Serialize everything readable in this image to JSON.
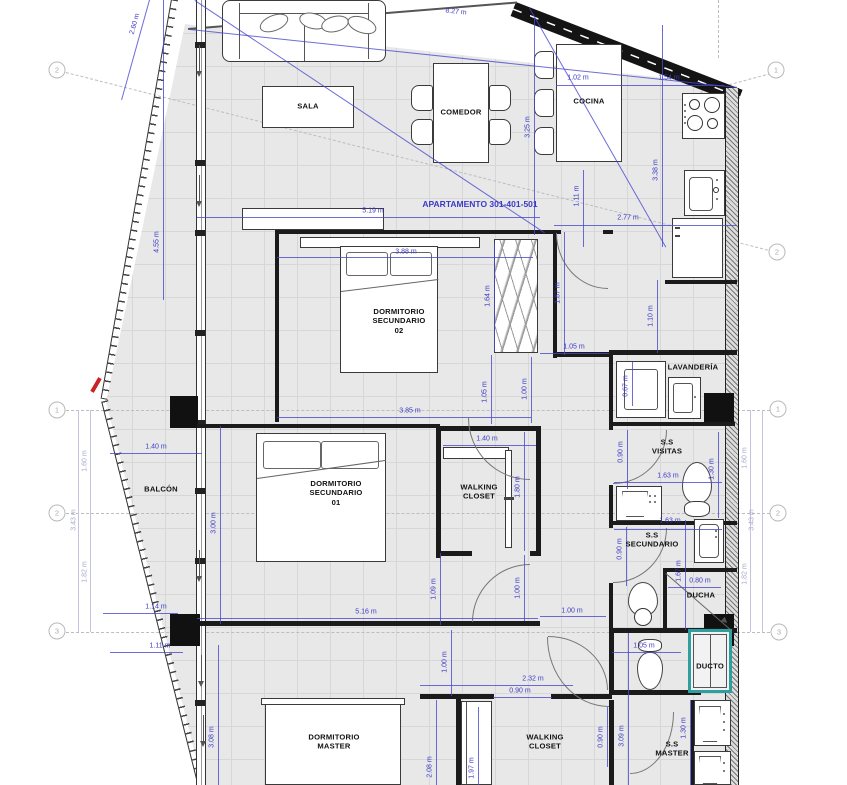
{
  "title": "APARTAMENTO 301-401-501",
  "colors": {
    "dimension_blue": "#3a3ac8",
    "dimension_faded": "#a9a9ce",
    "duct_teal": "#2e9e9e",
    "wall": "#1b1b1b",
    "floor": "#e8e8e8",
    "section_mark_red": "#cc2222"
  },
  "rooms": [
    {
      "name": "SALA",
      "x": 308,
      "y": 106
    },
    {
      "name": "COMEDOR",
      "x": 461,
      "y": 112
    },
    {
      "name": "COCINA",
      "x": 589,
      "y": 101
    },
    {
      "name": "DORMITORIO\nSECUNDARIO\n02",
      "x": 399,
      "y": 321
    },
    {
      "name": "LAVANDERÍA",
      "x": 693,
      "y": 367
    },
    {
      "name": "BALCÓN",
      "x": 161,
      "y": 489
    },
    {
      "name": "DORMITORIO\nSECUNDARIO\n01",
      "x": 336,
      "y": 493
    },
    {
      "name": "WALKING\nCLOSET",
      "x": 479,
      "y": 492
    },
    {
      "name": "S.S\nVISITAS",
      "x": 667,
      "y": 447
    },
    {
      "name": "S.S\nSECUNDARIO",
      "x": 652,
      "y": 540
    },
    {
      "name": "DUCHA",
      "x": 701,
      "y": 595
    },
    {
      "name": "DUCTO",
      "x": 710,
      "y": 666
    },
    {
      "name": "DORMITORIO\nMASTER",
      "x": 334,
      "y": 742
    },
    {
      "name": "WALKING\nCLOSET",
      "x": 545,
      "y": 742
    },
    {
      "name": "S.S\nMASTER",
      "x": 672,
      "y": 749
    }
  ],
  "dimensions": [
    {
      "text": "8.27 m",
      "x": 456,
      "y": 12,
      "rot": 6
    },
    {
      "text": "2.60 m",
      "x": 135,
      "y": 24,
      "rot": -74
    },
    {
      "text": "1.02 m",
      "x": 578,
      "y": 78,
      "rot": 0
    },
    {
      "text": "1.54 m",
      "x": 669,
      "y": 78,
      "rot": 0
    },
    {
      "text": "4.55 m",
      "x": 157,
      "y": 242,
      "rot": -90
    },
    {
      "text": "3.25 m",
      "x": 528,
      "y": 127,
      "rot": -90
    },
    {
      "text": "3.38 m",
      "x": 656,
      "y": 170,
      "rot": -90
    },
    {
      "text": "5.19 m",
      "x": 373,
      "y": 211,
      "rot": 0
    },
    {
      "text": "1.11 m",
      "x": 577,
      "y": 196,
      "rot": -90
    },
    {
      "text": "2.77 m",
      "x": 628,
      "y": 218,
      "rot": 0
    },
    {
      "text": "3.88 m",
      "x": 406,
      "y": 252,
      "rot": 0
    },
    {
      "text": "1.64 m",
      "x": 488,
      "y": 296,
      "rot": -90
    },
    {
      "text": "1.87 m",
      "x": 558,
      "y": 293,
      "rot": -90
    },
    {
      "text": "1.10 m",
      "x": 651,
      "y": 316,
      "rot": -90
    },
    {
      "text": "1.05 m",
      "x": 574,
      "y": 347,
      "rot": 0
    },
    {
      "text": "0.67 m",
      "x": 626,
      "y": 386,
      "rot": -90
    },
    {
      "text": "1.05 m",
      "x": 485,
      "y": 392,
      "rot": -90
    },
    {
      "text": "1.00 m",
      "x": 525,
      "y": 389,
      "rot": -90
    },
    {
      "text": "3.85 m",
      "x": 410,
      "y": 411,
      "rot": 0
    },
    {
      "text": "1.40 m",
      "x": 156,
      "y": 447,
      "rot": 0
    },
    {
      "text": "1.40 m",
      "x": 487,
      "y": 439,
      "rot": 0
    },
    {
      "text": "0.90 m",
      "x": 621,
      "y": 452,
      "rot": -90
    },
    {
      "text": "1.30 m",
      "x": 712,
      "y": 469,
      "rot": -90
    },
    {
      "text": "1.63 m",
      "x": 668,
      "y": 476,
      "rot": 0
    },
    {
      "text": "3.00 m",
      "x": 214,
      "y": 523,
      "rot": -90
    },
    {
      "text": "1.80 m",
      "x": 518,
      "y": 487,
      "rot": -90
    },
    {
      "text": "1.63 m",
      "x": 670,
      "y": 521,
      "rot": 0
    },
    {
      "text": "0.90 m",
      "x": 620,
      "y": 549,
      "rot": -90
    },
    {
      "text": "1.67 m",
      "x": 679,
      "y": 571,
      "rot": -90
    },
    {
      "text": "0.80 m",
      "x": 700,
      "y": 581,
      "rot": 0
    },
    {
      "text": "1.09 m",
      "x": 434,
      "y": 589,
      "rot": -90
    },
    {
      "text": "1.00 m",
      "x": 518,
      "y": 588,
      "rot": -90
    },
    {
      "text": "1.14 m",
      "x": 156,
      "y": 607,
      "rot": 0
    },
    {
      "text": "5.16 m",
      "x": 366,
      "y": 612,
      "rot": 0
    },
    {
      "text": "1.00 m",
      "x": 572,
      "y": 611,
      "rot": 0
    },
    {
      "text": "1.11 m",
      "x": 160,
      "y": 646,
      "rot": 0
    },
    {
      "text": "1.05 m",
      "x": 644,
      "y": 646,
      "rot": 0
    },
    {
      "text": "1.00 m",
      "x": 445,
      "y": 662,
      "rot": -90
    },
    {
      "text": "2.32 m",
      "x": 533,
      "y": 679,
      "rot": 0
    },
    {
      "text": "0.90 m",
      "x": 520,
      "y": 691,
      "rot": 0
    },
    {
      "text": "3.08 m",
      "x": 212,
      "y": 737,
      "rot": -90
    },
    {
      "text": "2.08 m",
      "x": 430,
      "y": 767,
      "rot": -90
    },
    {
      "text": "1.97 m",
      "x": 472,
      "y": 768,
      "rot": -90
    },
    {
      "text": "0.90 m",
      "x": 601,
      "y": 737,
      "rot": -90
    },
    {
      "text": "3.09 m",
      "x": 622,
      "y": 736,
      "rot": -90
    },
    {
      "text": "1.30 m",
      "x": 684,
      "y": 728,
      "rot": -90
    },
    {
      "text": "1.60 m",
      "x": 85,
      "y": 461,
      "rot": -90,
      "faded": true
    },
    {
      "text": "3.43 m",
      "x": 74,
      "y": 520,
      "rot": -90,
      "faded": true
    },
    {
      "text": "1.82 m",
      "x": 85,
      "y": 572,
      "rot": -90,
      "faded": true
    },
    {
      "text": "1.60 m",
      "x": 745,
      "y": 458,
      "rot": -90,
      "faded": true
    },
    {
      "text": "3.43 m",
      "x": 752,
      "y": 520,
      "rot": -90,
      "faded": true
    },
    {
      "text": "1.82 m",
      "x": 745,
      "y": 574,
      "rot": -90,
      "faded": true
    }
  ],
  "grid_bubbles": [
    {
      "label": "2",
      "x": 57,
      "y": 70
    },
    {
      "label": "1",
      "x": 57,
      "y": 410
    },
    {
      "label": "2",
      "x": 57,
      "y": 513
    },
    {
      "label": "3",
      "x": 57,
      "y": 631
    },
    {
      "label": "1",
      "x": 776,
      "y": 70
    },
    {
      "label": "2",
      "x": 777,
      "y": 252
    },
    {
      "label": "1",
      "x": 778,
      "y": 409
    },
    {
      "label": "2",
      "x": 778,
      "y": 513
    },
    {
      "label": "3",
      "x": 779,
      "y": 632
    }
  ]
}
